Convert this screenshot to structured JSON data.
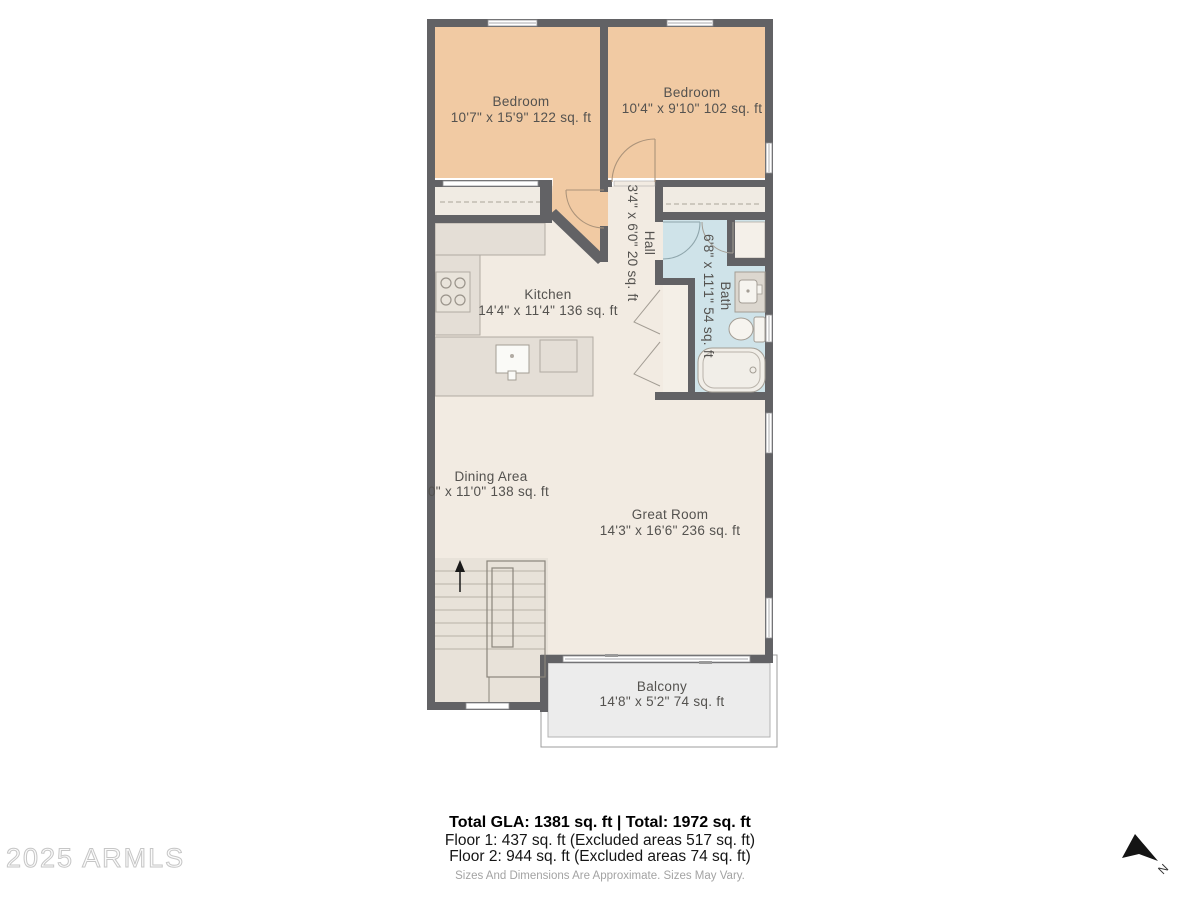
{
  "plan": {
    "rooms": {
      "bedroom1": {
        "label": "Bedroom",
        "dims": "10'7\" x 15'9\" 122 sq. ft"
      },
      "bedroom2": {
        "label": "Bedroom",
        "dims": "10'4\" x 9'10\" 102 sq. ft"
      },
      "hall": {
        "label": "Hall",
        "dims": "3'4\" x 6'0\" 20 sq. ft"
      },
      "bath": {
        "label": "Bath",
        "dims": "6'8\" x 11'1\" 54 sq. ft"
      },
      "kitchen": {
        "label": "Kitchen",
        "dims": "14'4\" x 11'4\" 136 sq. ft"
      },
      "dining": {
        "label": "Dining Area",
        "dims": "0\" x 11'0\" 138 sq. ft"
      },
      "great_room": {
        "label": "Great Room",
        "dims": "14'3\" x 16'6\" 236 sq. ft"
      },
      "balcony": {
        "label": "Balcony",
        "dims": "14'8\" x 5'2\" 74 sq. ft"
      }
    },
    "compass": {
      "label": "N"
    }
  },
  "footer": {
    "total_line": "Total GLA: 1381 sq. ft | Total: 1972 sq. ft",
    "floor1_line": "Floor 1: 437 sq. ft (Excluded areas 517 sq. ft)",
    "floor2_line": "Floor 2: 944 sq. ft (Excluded areas 74 sq. ft)",
    "disclaimer": "Sizes And Dimensions Are Approximate. Sizes May Vary."
  },
  "watermark": {
    "text": "2025 ARMLS"
  },
  "colors": {
    "wall": "#626265",
    "bedroom_floor": "#f1caa3",
    "main_floor": "#f2ebe2",
    "bath_floor": "#cfe3e9",
    "counter": "#e4ded6",
    "stairs_floor": "#e8e2d9",
    "balcony_floor": "#ececec"
  }
}
